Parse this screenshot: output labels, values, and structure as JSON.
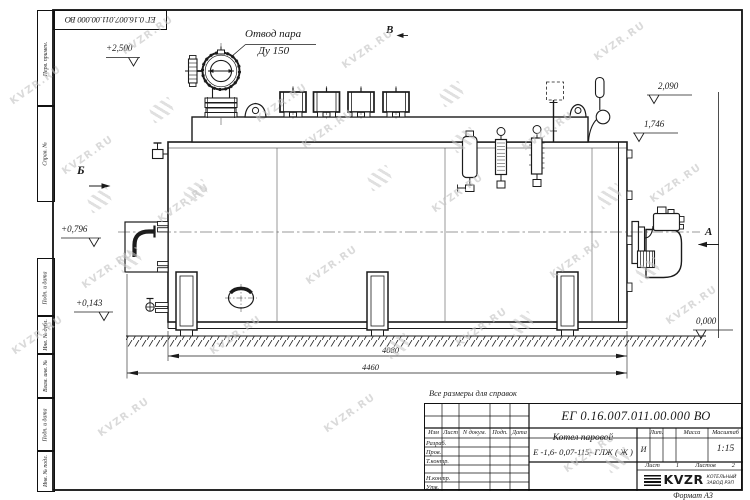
{
  "watermark": {
    "text": "KVZR.RU"
  },
  "frame": {
    "top_stamp": "ЕГ 0.16.007.011.00.000  ВО",
    "margin_labels": [
      "Перв. примен.",
      "Справ. №",
      "Подп. и дата",
      "Инв. № дубл.",
      "Взам. инв. №",
      "Подп. и дата",
      "Инв. № подл."
    ],
    "format_note": "Формат А3"
  },
  "views": {
    "a": "А",
    "b": "Б",
    "v": "В"
  },
  "callout": {
    "line1": "Отвод пара",
    "line2": "Ду 150"
  },
  "elevations": [
    "+2,500",
    "2,090",
    "1,746",
    "+0,796",
    "+0,143",
    "0,000"
  ],
  "dimensions": [
    "4080",
    "4460"
  ],
  "notes": {
    "reference": "Все размеры для справок"
  },
  "title_block": {
    "doc_number": "ЕГ 0.16.007.011.00.000  ВО",
    "product_line1": "Котел паровой",
    "product_line2": "Е -1,6- 0,07-115- ГЛЖ ( Ж )",
    "header_cols": [
      "Изм",
      "Лист",
      "N докум.",
      "Подп.",
      "Дата"
    ],
    "row_labels": [
      "Разраб.",
      "Пров.",
      "Т.контр.",
      "Н.контр.",
      "Утв."
    ],
    "lit_label": "Лит.",
    "lit_value": "И",
    "mass_label": "Масса",
    "scale_label": "Масштаб",
    "scale_value": "1:15",
    "sheet_label": "Лист",
    "sheet_value": "1",
    "sheets_label": "Листов",
    "sheets_value": "2",
    "company_name": "KVZR",
    "company_sub1": "КОТЕЛЬНЫЙ",
    "company_sub2": "ЗАВОД РЭП"
  }
}
